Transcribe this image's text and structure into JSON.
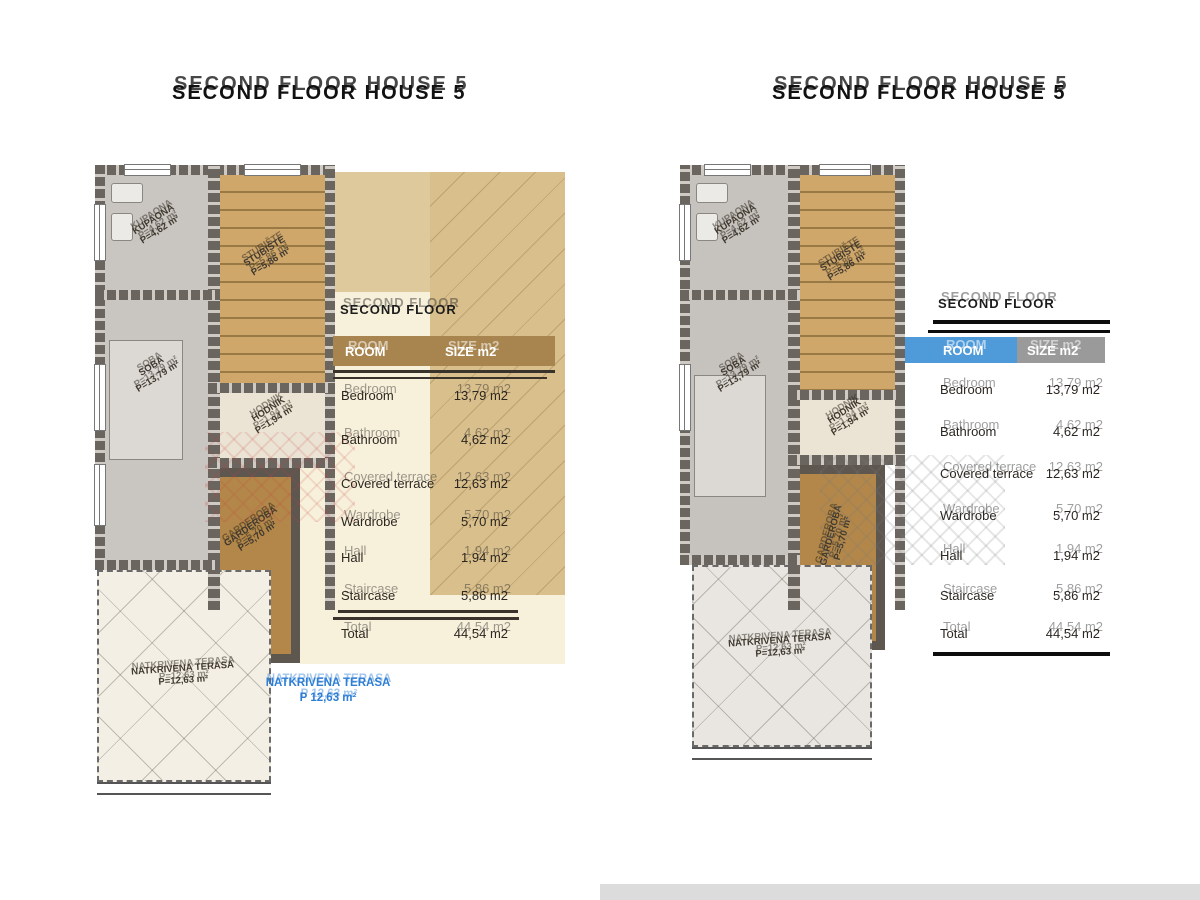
{
  "left": {
    "title": "SECOND FLOOR HOUSE 5",
    "plan": {
      "kupaona": {
        "name": "KUPAONA",
        "area": "P=4,62 m²"
      },
      "stubiste": {
        "name": "STUBIŠTE",
        "area": "P=5,86 m²"
      },
      "soba": {
        "name": "SOBA",
        "area": "P=13,79 m²"
      },
      "hodnik": {
        "name": "HODNIK",
        "area": "P=1,94 m²"
      },
      "garderoba": {
        "name": "GARDEROBA",
        "area": "P=5,70 m²"
      },
      "terasa": {
        "name": "NATKRIVENA TERASA",
        "area": "P=12,63 m²"
      },
      "terasa_overlay": {
        "name": "NATKRIVENA TERASA",
        "area": "P 12,63 m²"
      }
    },
    "table": {
      "title": "SECOND FLOOR",
      "header": {
        "room": "ROOM",
        "size": "SIZE m2"
      },
      "rows": [
        {
          "label": "Bedroom",
          "value": "13,79 m2"
        },
        {
          "label": "Bathroom",
          "value": "4,62 m2"
        },
        {
          "label": "Covered terrace",
          "value": "12,63 m2"
        },
        {
          "label": "Wardrobe",
          "value": "5,70 m2"
        },
        {
          "label": "Hall",
          "value": "1,94 m2"
        },
        {
          "label": "Staircase",
          "value": "5,86 m2"
        }
      ],
      "total": {
        "label": "Total",
        "value": "44,54 m2"
      }
    }
  },
  "right": {
    "title": "SECOND FLOOR HOUSE 5",
    "plan": {
      "kupaona": {
        "name": "KUPAONA",
        "area": "P=4,62 m²"
      },
      "stubiste": {
        "name": "STUBIŠTE",
        "area": "P=5,86 m²"
      },
      "soba": {
        "name": "SOBA",
        "area": "P=13,79 m²"
      },
      "hodnik": {
        "name": "HODNIK",
        "area": "P=1,94 m²"
      },
      "garderoba": {
        "name": "GARDEROBA",
        "area": "P=5,70 m²"
      },
      "terasa": {
        "name": "NATKRIVENA TERASA",
        "area": "P=12,63 m²"
      }
    },
    "table": {
      "title": "SECOND FLOOR",
      "header": {
        "room": "ROOM",
        "size": "SIZE m2"
      },
      "rows": [
        {
          "label": "Bedroom",
          "value": "13,79 m2"
        },
        {
          "label": "Bathroom",
          "value": "4,62 m2"
        },
        {
          "label": "Covered terrace",
          "value": "12,63 m2"
        },
        {
          "label": "Wardrobe",
          "value": "5,70 m2"
        },
        {
          "label": "Hall",
          "value": "1,94 m2"
        },
        {
          "label": "Staircase",
          "value": "5,86 m2"
        }
      ],
      "total": {
        "label": "Total",
        "value": "44,54 m2"
      }
    }
  },
  "colors": {
    "header_blue": "#4f9ad9",
    "header_gray": "#9a9a9a",
    "header_brown": "#a8854f",
    "overlay_blue": "#2e7ed5",
    "stair_tan": "#cfa76b",
    "wall_gray": "#6b655f"
  }
}
